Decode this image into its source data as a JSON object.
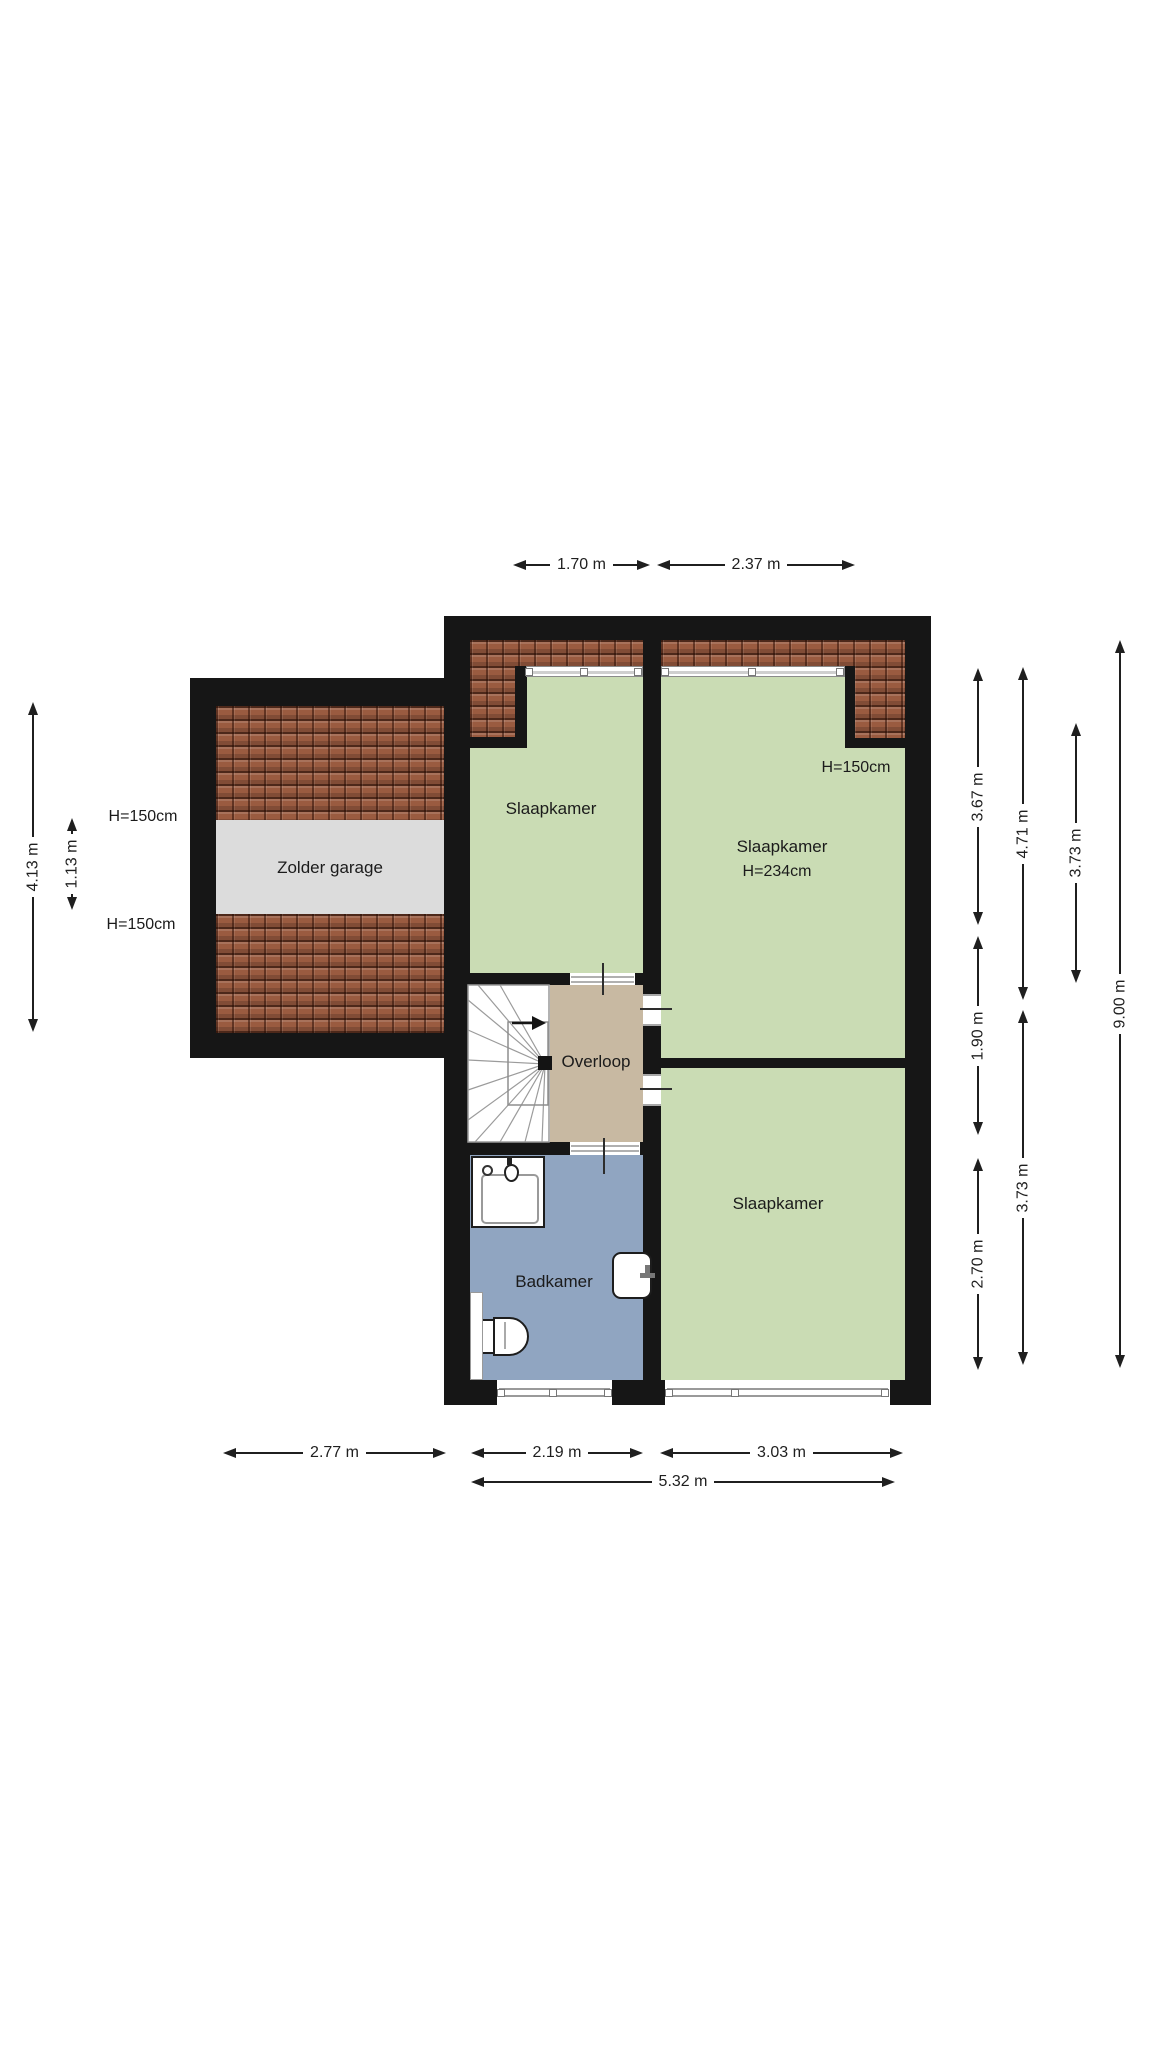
{
  "plan": {
    "type": "floor-plan",
    "floor_name": "first floor / attic",
    "rooms": {
      "zolder_garage": {
        "label": "Zolder garage"
      },
      "slaapkamer_nw": {
        "label": "Slaapkamer"
      },
      "slaapkamer_ne": {
        "label": "Slaapkamer",
        "ceiling_height": "H=234cm",
        "knee_wall_height": "H=150cm"
      },
      "slaapkamer_se": {
        "label": "Slaapkamer"
      },
      "overloop": {
        "label": "Overloop"
      },
      "badkamer": {
        "label": "Badkamer"
      }
    },
    "garage_annotations": {
      "knee_wall_top": "H=150cm",
      "knee_wall_bottom": "H=150cm"
    },
    "dimensions": {
      "top": {
        "window_left": "1.70 m",
        "window_right": "2.37 m"
      },
      "bottom": {
        "garage_width": "2.77 m",
        "badkamer_width": "2.19 m",
        "slaapkamer_width": "3.03 m",
        "total_width": "5.32 m"
      },
      "left": {
        "garage_depth": "4.13 m",
        "attic_band_depth": "1.13 m"
      },
      "right": {
        "seg_top": "3.67 m",
        "seg_mid": "1.90 m",
        "seg_bottom": "2.70 m",
        "col2_top": "4.71 m",
        "col2_bottom": "3.73 m",
        "slaapkamer_ne_depth": "3.73 m",
        "total_depth": "9.00 m"
      }
    },
    "colors": {
      "room_green": "#cadcb4",
      "landing_tan": "#c8b9a2",
      "bath_blue": "#90a5c1",
      "roof_base": "#9a5b40",
      "garage_band": "#dcdcdc",
      "wall": "#161616",
      "dim": "#1f1f1f"
    }
  }
}
